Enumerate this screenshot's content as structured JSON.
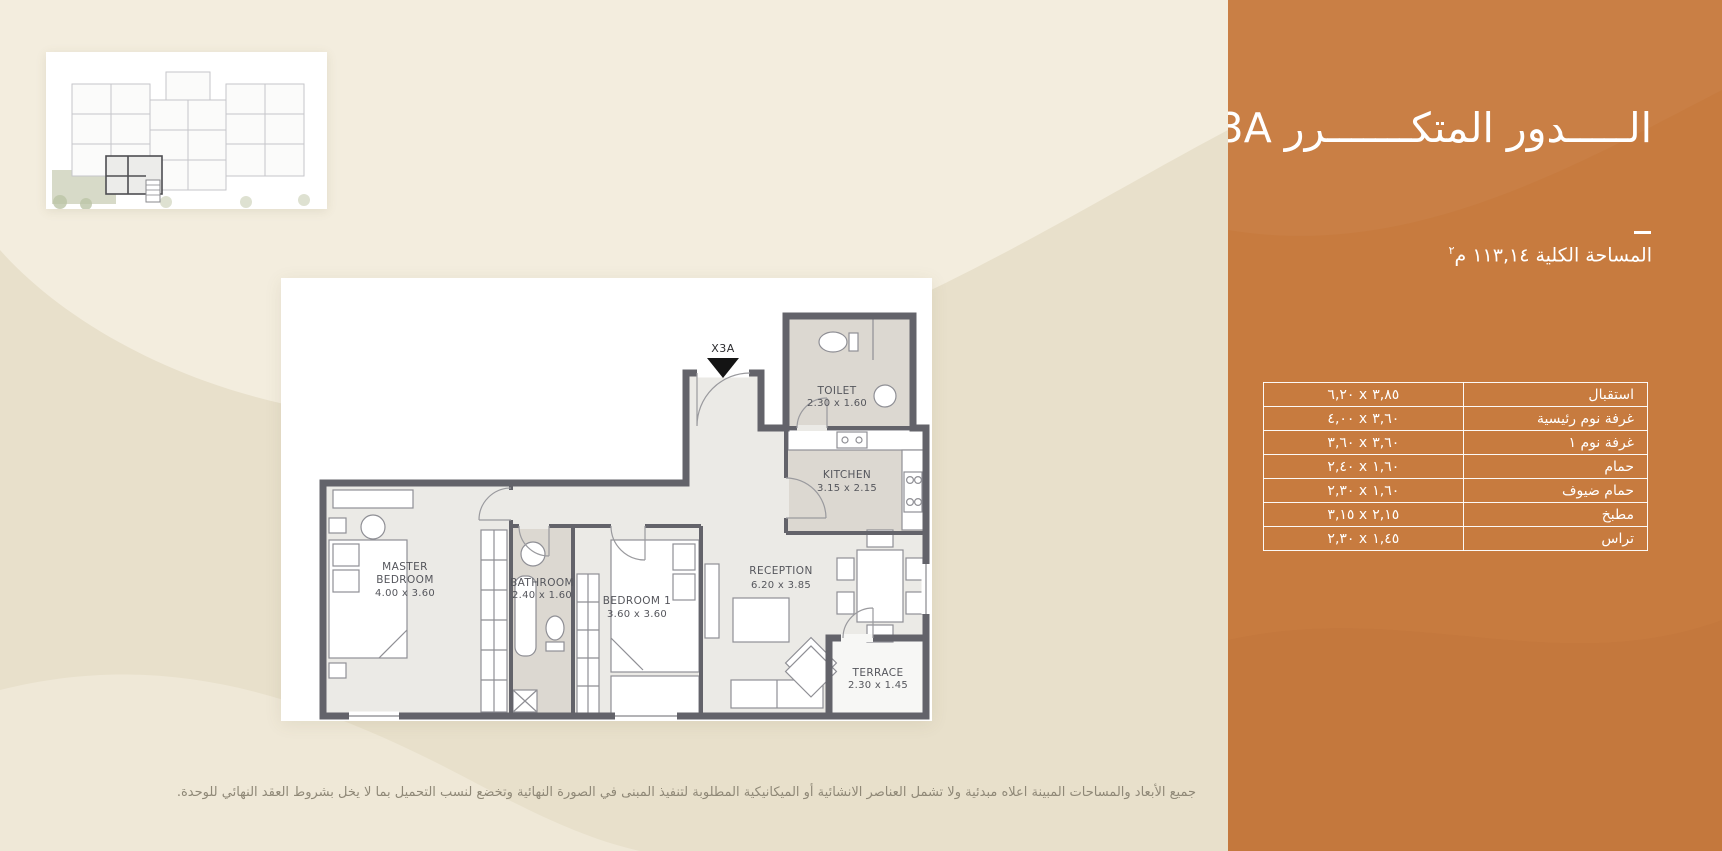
{
  "page": {
    "bg_base": "#e8e0cb",
    "bg_light": "#f3edde",
    "accent_orange": "#c77b3f"
  },
  "sidebar": {
    "title": "الـــــدور المتكـــــــرر X3A",
    "total_area_label": "المساحة الكلية ١١٣,١٤ م",
    "total_area_sup": "٢",
    "table": {
      "rows": [
        {
          "name": "استقبال",
          "dims": "٦,٢٠ x ٣,٨٥"
        },
        {
          "name": "غرفة نوم رئيسية",
          "dims": "٤,٠٠ x ٣,٦٠"
        },
        {
          "name": "غرفة نوم ١",
          "dims": "٣,٦٠ x ٣,٦٠"
        },
        {
          "name": "حمام",
          "dims": "٢,٤٠ x ١,٦٠"
        },
        {
          "name": "حمام ضيوف",
          "dims": "٢,٣٠ x ١,٦٠"
        },
        {
          "name": "مطبخ",
          "dims": "٣,١٥ x ٢,١٥"
        },
        {
          "name": "تراس",
          "dims": "٢,٣٠ x ١,٤٥"
        }
      ]
    }
  },
  "plan": {
    "entry_label": "X3A",
    "rooms": {
      "master": {
        "line1": "MASTER",
        "line2": "BEDROOM",
        "dims": "4.00 x 3.60"
      },
      "bathroom": {
        "line1": "BATHROOM",
        "dims": "2.40 x 1.60"
      },
      "bedroom1": {
        "line1": "BEDROOM 1",
        "dims": "3.60 x 3.60"
      },
      "reception": {
        "line1": "RECEPTION",
        "dims": "6.20 x 3.85"
      },
      "kitchen": {
        "line1": "KITCHEN",
        "dims": "3.15 x 2.15"
      },
      "toilet": {
        "line1": "TOILET",
        "dims": "2.30 x 1.60"
      },
      "terrace": {
        "line1": "TERRACE",
        "dims": "2.30 x 1.45"
      }
    }
  },
  "footer": {
    "disclaimer": "جميع الأبعاد والمساحات المبينة اعلاه مبدئية ولا تشمل العناصر الانشائية أو الميكانيكية المطلوبة لتنفيذ المبنى في الصورة النهائية وتخضع لنسب التحميل بما لا يخل بشروط العقد النهائي للوحدة."
  }
}
